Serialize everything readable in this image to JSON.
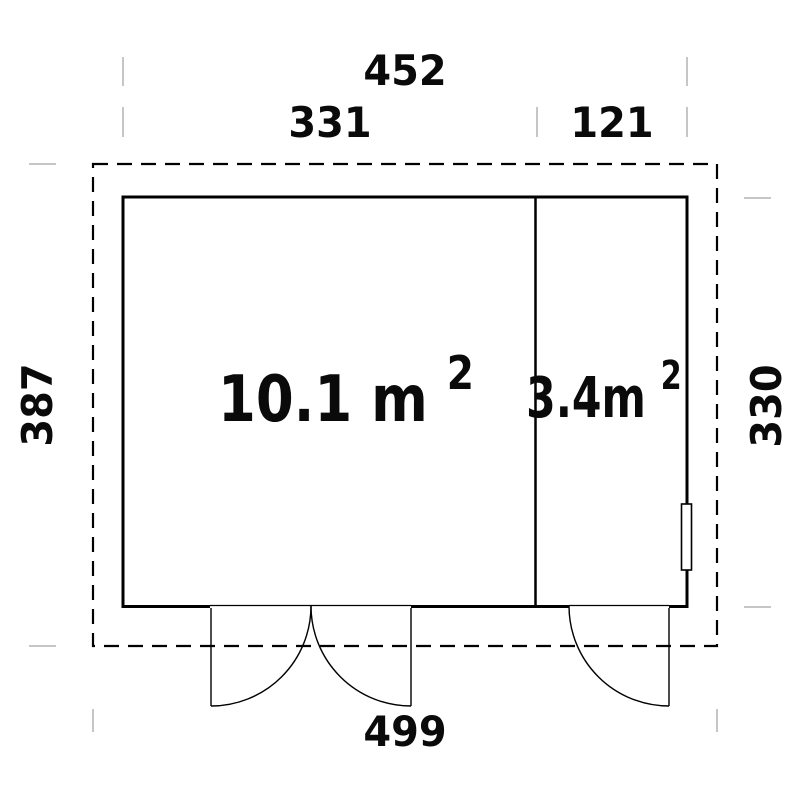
{
  "drawing": {
    "type": "floor-plan",
    "colors": {
      "line": "#000000",
      "tick": "#c6c6c6",
      "background": "#ffffff"
    },
    "dimensions": {
      "top_total": "452",
      "top_left_section": "331",
      "top_right_section": "121",
      "left_height": "387",
      "right_height": "330",
      "bottom_total": "499"
    },
    "rooms": [
      {
        "name": "main-room",
        "area_value": "10.1 m",
        "area_sup": "2"
      },
      {
        "name": "side-room",
        "area_value": "3.4m",
        "area_sup": "2"
      }
    ]
  }
}
